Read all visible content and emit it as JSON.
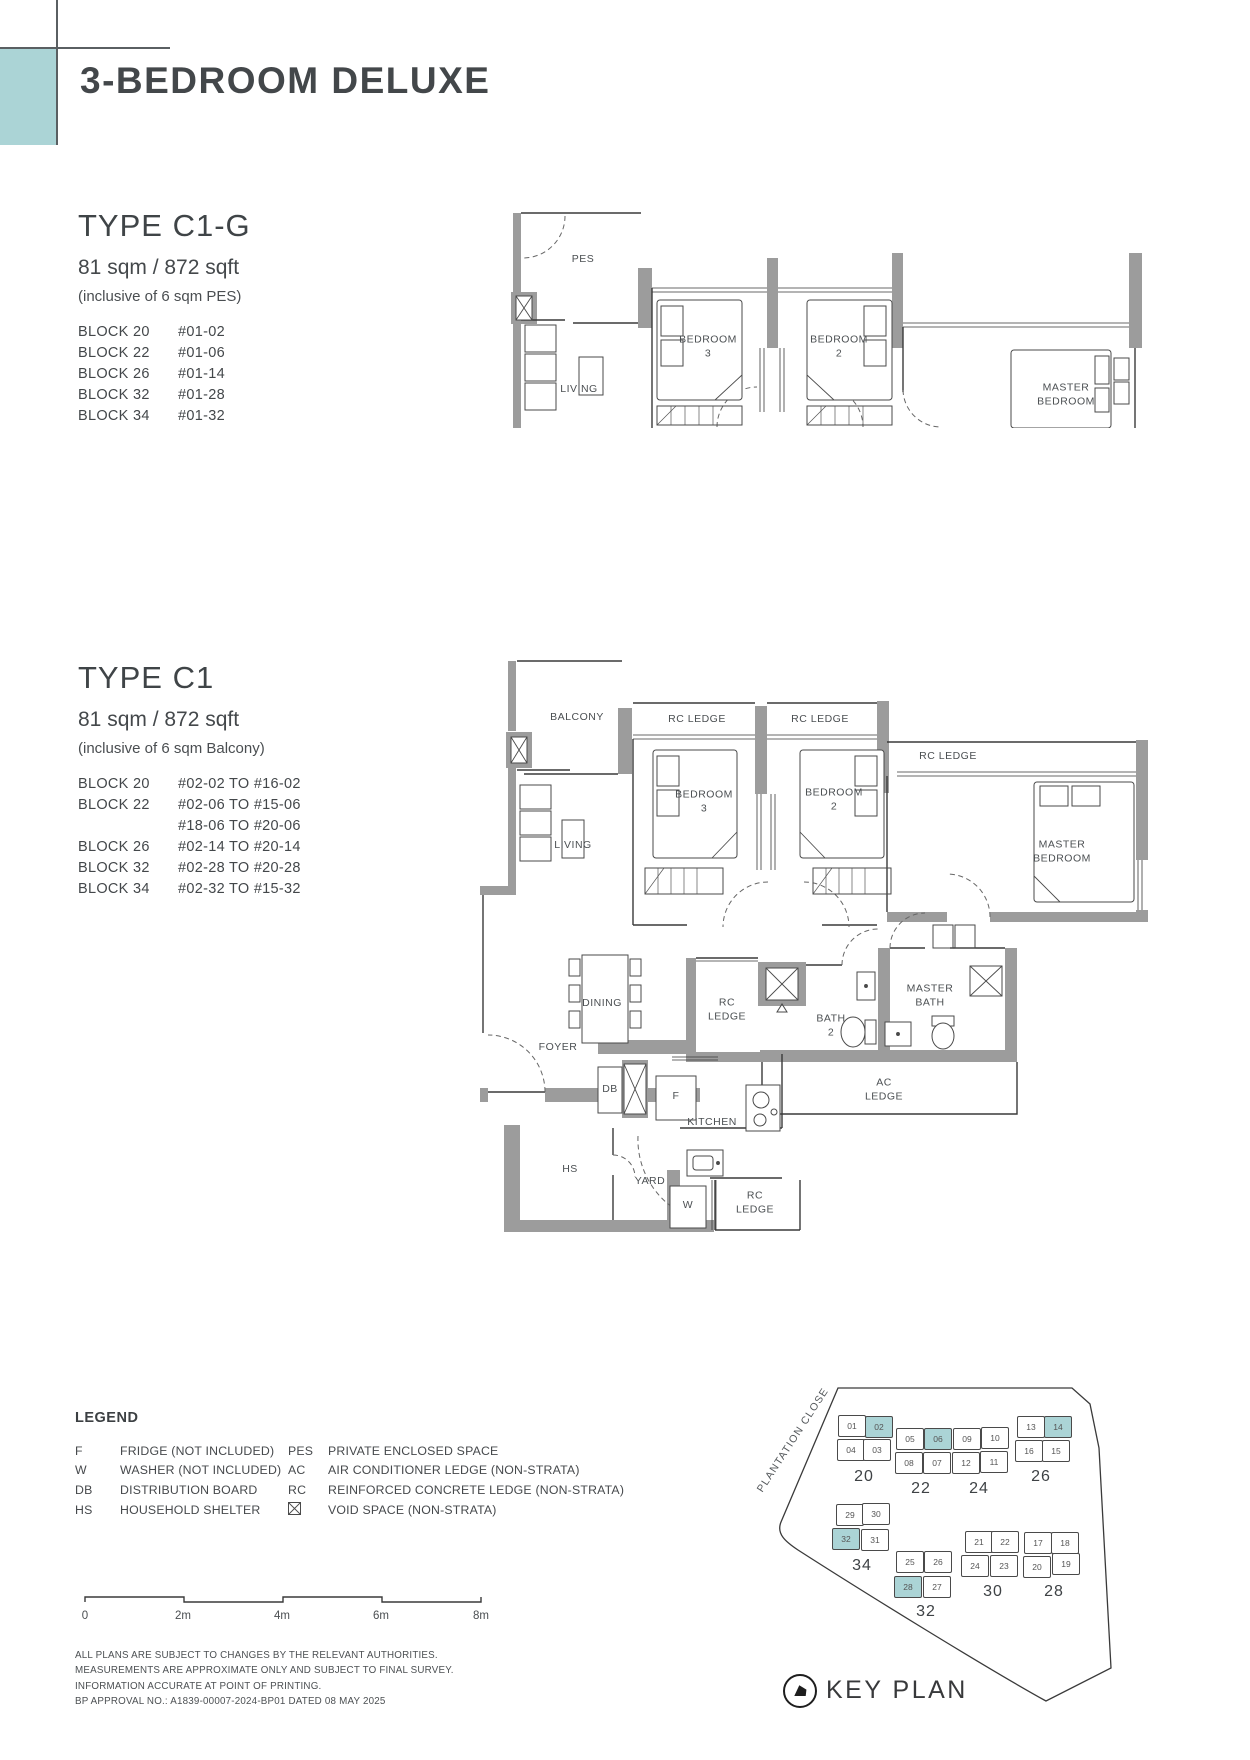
{
  "header": {
    "title": "3-BEDROOM DELUXE"
  },
  "type_c1g": {
    "name": "TYPE C1-G",
    "area": "81 sqm / 872 sqft",
    "note": "(inclusive of 6 sqm PES)",
    "blocks": [
      {
        "block": "BLOCK 20",
        "units": "#01-02"
      },
      {
        "block": "BLOCK 22",
        "units": "#01-06"
      },
      {
        "block": "BLOCK 26",
        "units": "#01-14"
      },
      {
        "block": "BLOCK 32",
        "units": "#01-28"
      },
      {
        "block": "BLOCK 34",
        "units": "#01-32"
      }
    ],
    "labels": {
      "pes": "PES",
      "living": "LIVING",
      "bedroom3": "BEDROOM\n3",
      "bedroom2": "BEDROOM\n2",
      "master_bedroom": "MASTER\nBEDROOM"
    }
  },
  "type_c1": {
    "name": "TYPE C1",
    "area": "81 sqm / 872 sqft",
    "note": "(inclusive of 6 sqm Balcony)",
    "blocks": [
      {
        "block": "BLOCK 20",
        "units": "#02-02 TO #16-02"
      },
      {
        "block": "BLOCK 22",
        "units": "#02-06 TO #15-06"
      },
      {
        "block": "",
        "units": "#18-06 TO #20-06"
      },
      {
        "block": "BLOCK 26",
        "units": "#02-14 TO #20-14"
      },
      {
        "block": "BLOCK 32",
        "units": "#02-28 TO #20-28"
      },
      {
        "block": "BLOCK 34",
        "units": "#02-32 TO #15-32"
      }
    ],
    "labels": {
      "balcony": "BALCONY",
      "rc_ledge_1": "RC LEDGE",
      "rc_ledge_2": "RC LEDGE",
      "rc_ledge_right": "RC LEDGE",
      "bedroom3": "BEDROOM\n3",
      "bedroom2": "BEDROOM\n2",
      "master_bedroom": "MASTER\nBEDROOM",
      "living": "LIVING",
      "dining": "DINING",
      "foyer": "FOYER",
      "db": "DB",
      "fridge": "F",
      "kitchen": "KITCHEN",
      "hs": "HS",
      "yard": "YARD",
      "washer": "W",
      "rc_ledge_mid": "RC\nLEDGE",
      "rc_ledge_yard": "RC\nLEDGE",
      "bath2": "BATH\n2",
      "master_bath": "MASTER\nBATH",
      "ac_ledge": "AC\nLEDGE"
    }
  },
  "legend": {
    "heading": "LEGEND",
    "col1": [
      {
        "abbr": "F",
        "desc": "FRIDGE (NOT INCLUDED)"
      },
      {
        "abbr": "W",
        "desc": "WASHER (NOT INCLUDED)"
      },
      {
        "abbr": "DB",
        "desc": "DISTRIBUTION BOARD"
      },
      {
        "abbr": "HS",
        "desc": "HOUSEHOLD SHELTER"
      }
    ],
    "col2": [
      {
        "abbr": "PES",
        "desc": "PRIVATE ENCLOSED SPACE"
      },
      {
        "abbr": "AC",
        "desc": "AIR CONDITIONER LEDGE (NON-STRATA)"
      },
      {
        "abbr": "RC",
        "desc": "REINFORCED CONCRETE LEDGE (NON-STRATA)"
      },
      {
        "abbr": "",
        "icon": "void-space-box",
        "desc": "VOID SPACE (NON-STRATA)"
      }
    ]
  },
  "scale_bar": {
    "labels": [
      "0",
      "2m",
      "4m",
      "6m",
      "8m"
    ]
  },
  "disclaimer": [
    "ALL PLANS ARE SUBJECT TO CHANGES BY THE RELEVANT AUTHORITIES.",
    "MEASUREMENTS ARE APPROXIMATE ONLY AND SUBJECT TO FINAL SURVEY.",
    "INFORMATION ACCURATE AT POINT OF PRINTING.",
    "BP APPROVAL NO.: A1839-00007-2024-BP01 DATED 08 MAY 2025"
  ],
  "key_plan": {
    "title": "KEY PLAN",
    "street": "PLANTATION CLOSE",
    "highlight_color": "#abd4d6",
    "blocks": [
      {
        "label": "20",
        "units": [
          {
            "no": "01"
          },
          {
            "no": "02",
            "hl": true
          },
          {
            "no": "04"
          },
          {
            "no": "03"
          }
        ]
      },
      {
        "label": "22",
        "units": [
          {
            "no": "05"
          },
          {
            "no": "06",
            "hl": true
          },
          {
            "no": "08"
          },
          {
            "no": "07"
          }
        ]
      },
      {
        "label": "24",
        "units": [
          {
            "no": "09"
          },
          {
            "no": "10"
          },
          {
            "no": "12"
          },
          {
            "no": "11"
          }
        ]
      },
      {
        "label": "26",
        "units": [
          {
            "no": "13"
          },
          {
            "no": "14",
            "hl": true
          },
          {
            "no": "16"
          },
          {
            "no": "15"
          }
        ]
      },
      {
        "label": "34",
        "units": [
          {
            "no": "29"
          },
          {
            "no": "30"
          },
          {
            "no": "32",
            "hl": true
          },
          {
            "no": "31"
          }
        ]
      },
      {
        "label": "32",
        "units": [
          {
            "no": "25"
          },
          {
            "no": "26"
          },
          {
            "no": "28",
            "hl": true
          },
          {
            "no": "27"
          }
        ]
      },
      {
        "label": "30",
        "units": [
          {
            "no": "21"
          },
          {
            "no": "22"
          },
          {
            "no": "24"
          },
          {
            "no": "23"
          }
        ]
      },
      {
        "label": "28",
        "units": [
          {
            "no": "17"
          },
          {
            "no": "18"
          },
          {
            "no": "20"
          },
          {
            "no": "19"
          }
        ]
      }
    ]
  }
}
